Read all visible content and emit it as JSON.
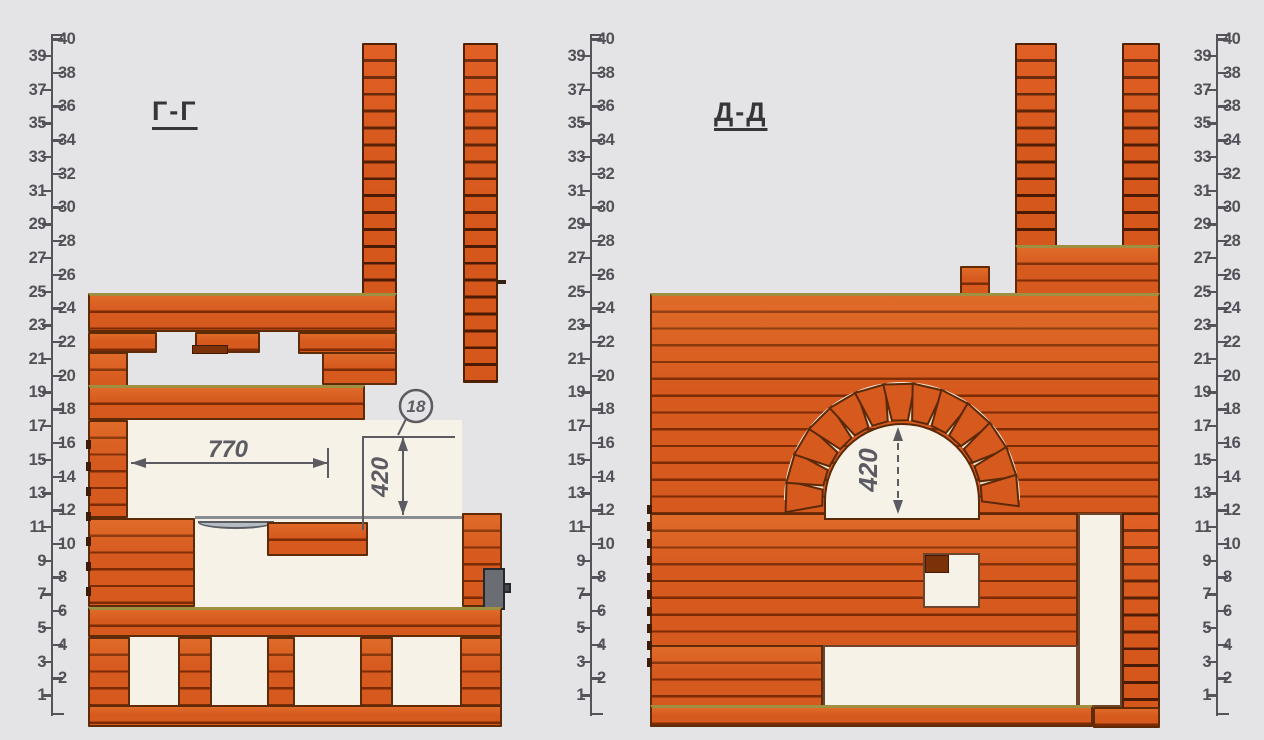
{
  "drawing": {
    "type": "masonry stove cross-sections, brick course diagram",
    "sections": [
      {
        "id": "G",
        "label": "Г-Г"
      },
      {
        "id": "D",
        "label": "Д-Д"
      }
    ]
  },
  "annotations": {
    "g_firebox_width": "770",
    "g_opening_height": "420",
    "g_callout": "18",
    "d_arch_height": "420"
  },
  "rulers": {
    "left": {
      "numbers": [
        1,
        2,
        3,
        4,
        5,
        6,
        7,
        8,
        9,
        10,
        11,
        12,
        13,
        14,
        15,
        16,
        17,
        18,
        19,
        20,
        21,
        22,
        23,
        24,
        25,
        26,
        27,
        28,
        29,
        30,
        31,
        32,
        33,
        34,
        35,
        36,
        37,
        38,
        39,
        40
      ]
    },
    "middle": {
      "numbers": [
        1,
        2,
        3,
        4,
        5,
        6,
        7,
        8,
        9,
        10,
        11,
        12,
        13,
        14,
        15,
        16,
        17,
        18,
        19,
        20,
        21,
        22,
        23,
        24,
        25,
        26,
        27,
        28,
        29,
        30,
        31,
        32,
        33,
        34,
        35,
        36,
        37,
        38,
        39,
        40
      ]
    },
    "right": {
      "numbers": [
        1,
        2,
        3,
        4,
        5,
        6,
        7,
        8,
        9,
        10,
        11,
        12,
        13,
        14,
        15,
        16,
        17,
        18,
        19,
        20,
        21,
        22,
        23,
        24,
        25,
        26,
        27,
        28,
        29,
        30,
        31,
        32,
        33,
        34,
        35,
        38,
        37,
        38,
        39,
        40
      ]
    }
  },
  "colors": {
    "background": "#e4e3e6",
    "brick": "#d6591e",
    "mortar": "#7c2b05",
    "outline": "#5f2a06",
    "interior": "#f6f2e8",
    "olive_edge": "#9e9040",
    "ruler": "#55545a",
    "dimension": "#5c5b62",
    "metal_damper": "#6a6e74",
    "arch_joint": "#efe6d2"
  }
}
